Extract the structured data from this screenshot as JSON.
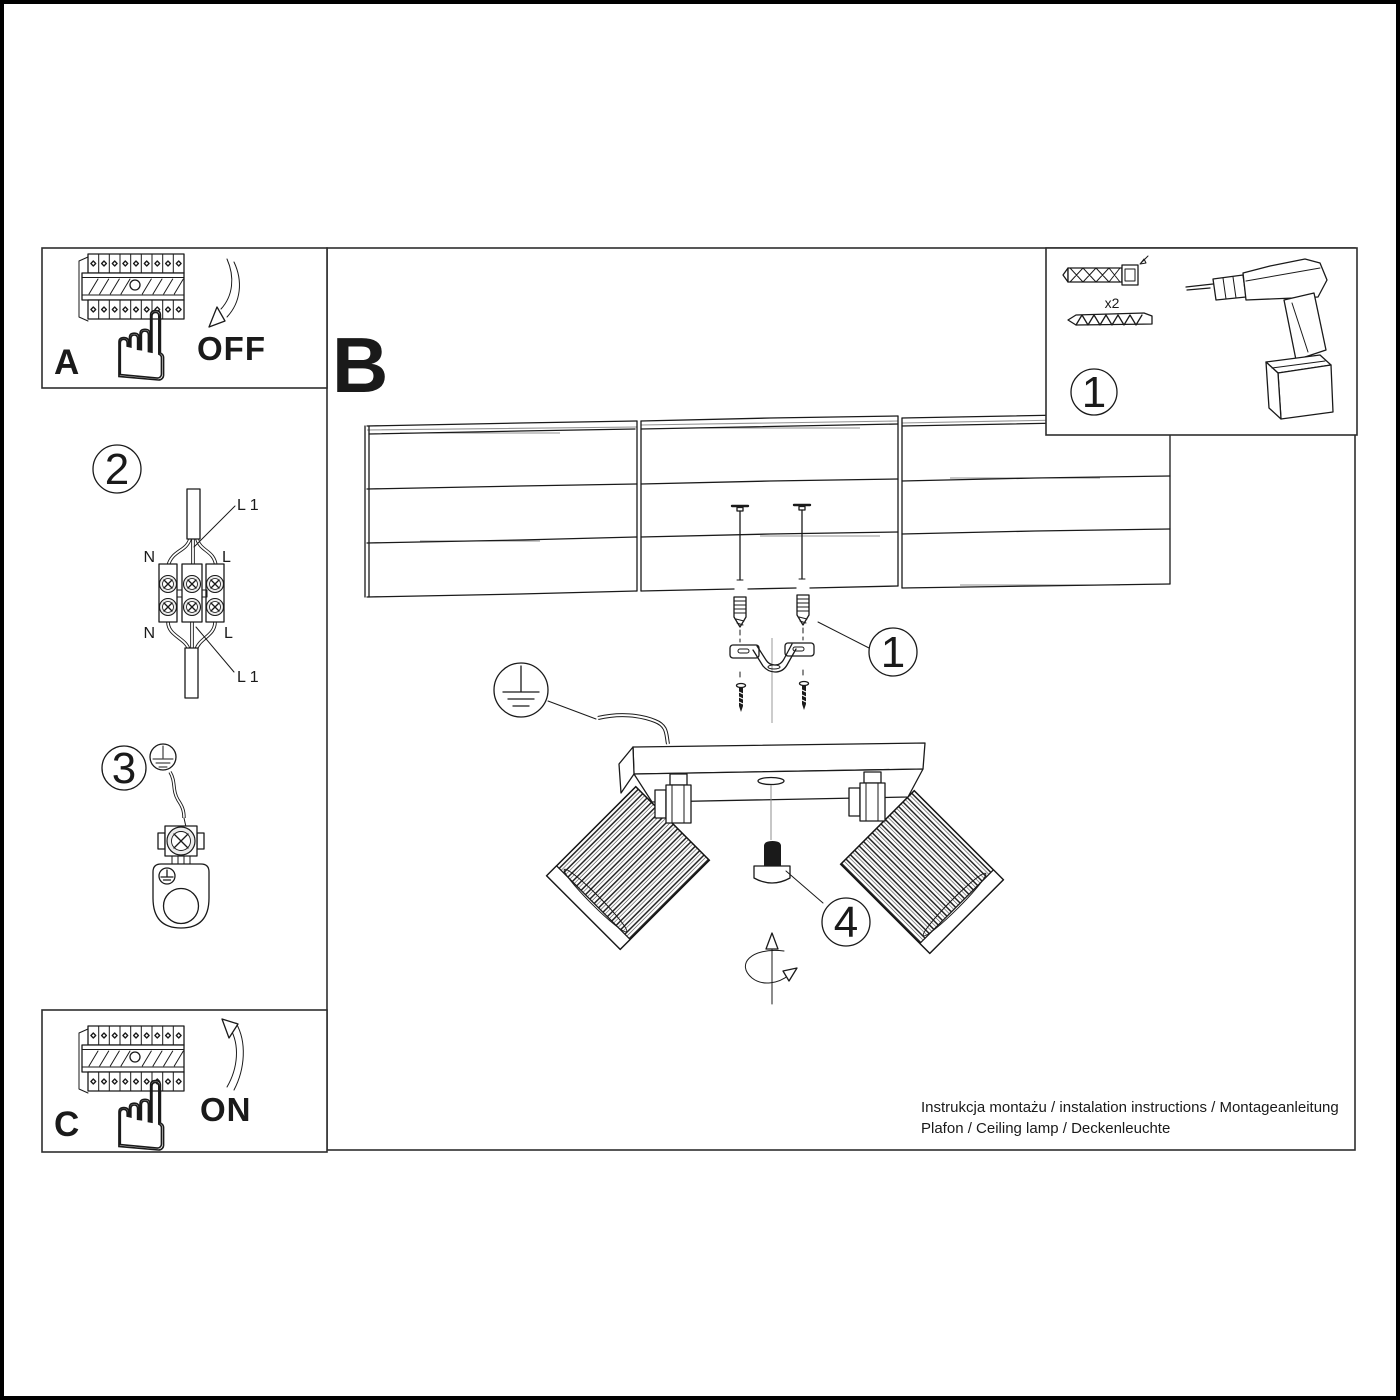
{
  "colors": {
    "ink": "#1a1a1a",
    "paper": "#ffffff"
  },
  "icons": {
    "pointing_hand_glyph": "☝"
  },
  "panel_a": {
    "label": "A",
    "action_label": "OFF"
  },
  "section_b": {
    "label": "B"
  },
  "panel_c": {
    "label": "C",
    "action_label": "ON"
  },
  "step1": {
    "badge": "1",
    "quantity": "x2"
  },
  "step2": {
    "badge": "2",
    "labels": {
      "n_top": "N",
      "l_top": "L",
      "l1_top": "L 1",
      "n_bottom": "N",
      "l_bottom": "L",
      "l1_bottom": "L 1"
    }
  },
  "step3": {
    "badge": "3"
  },
  "callouts": {
    "bracket": "1",
    "knob": "4"
  },
  "footer": {
    "line1": "Instrukcja montażu / instalation instructions / Montageanleitung",
    "line2": "Plafon / Ceiling lamp / Deckenleuchte"
  }
}
